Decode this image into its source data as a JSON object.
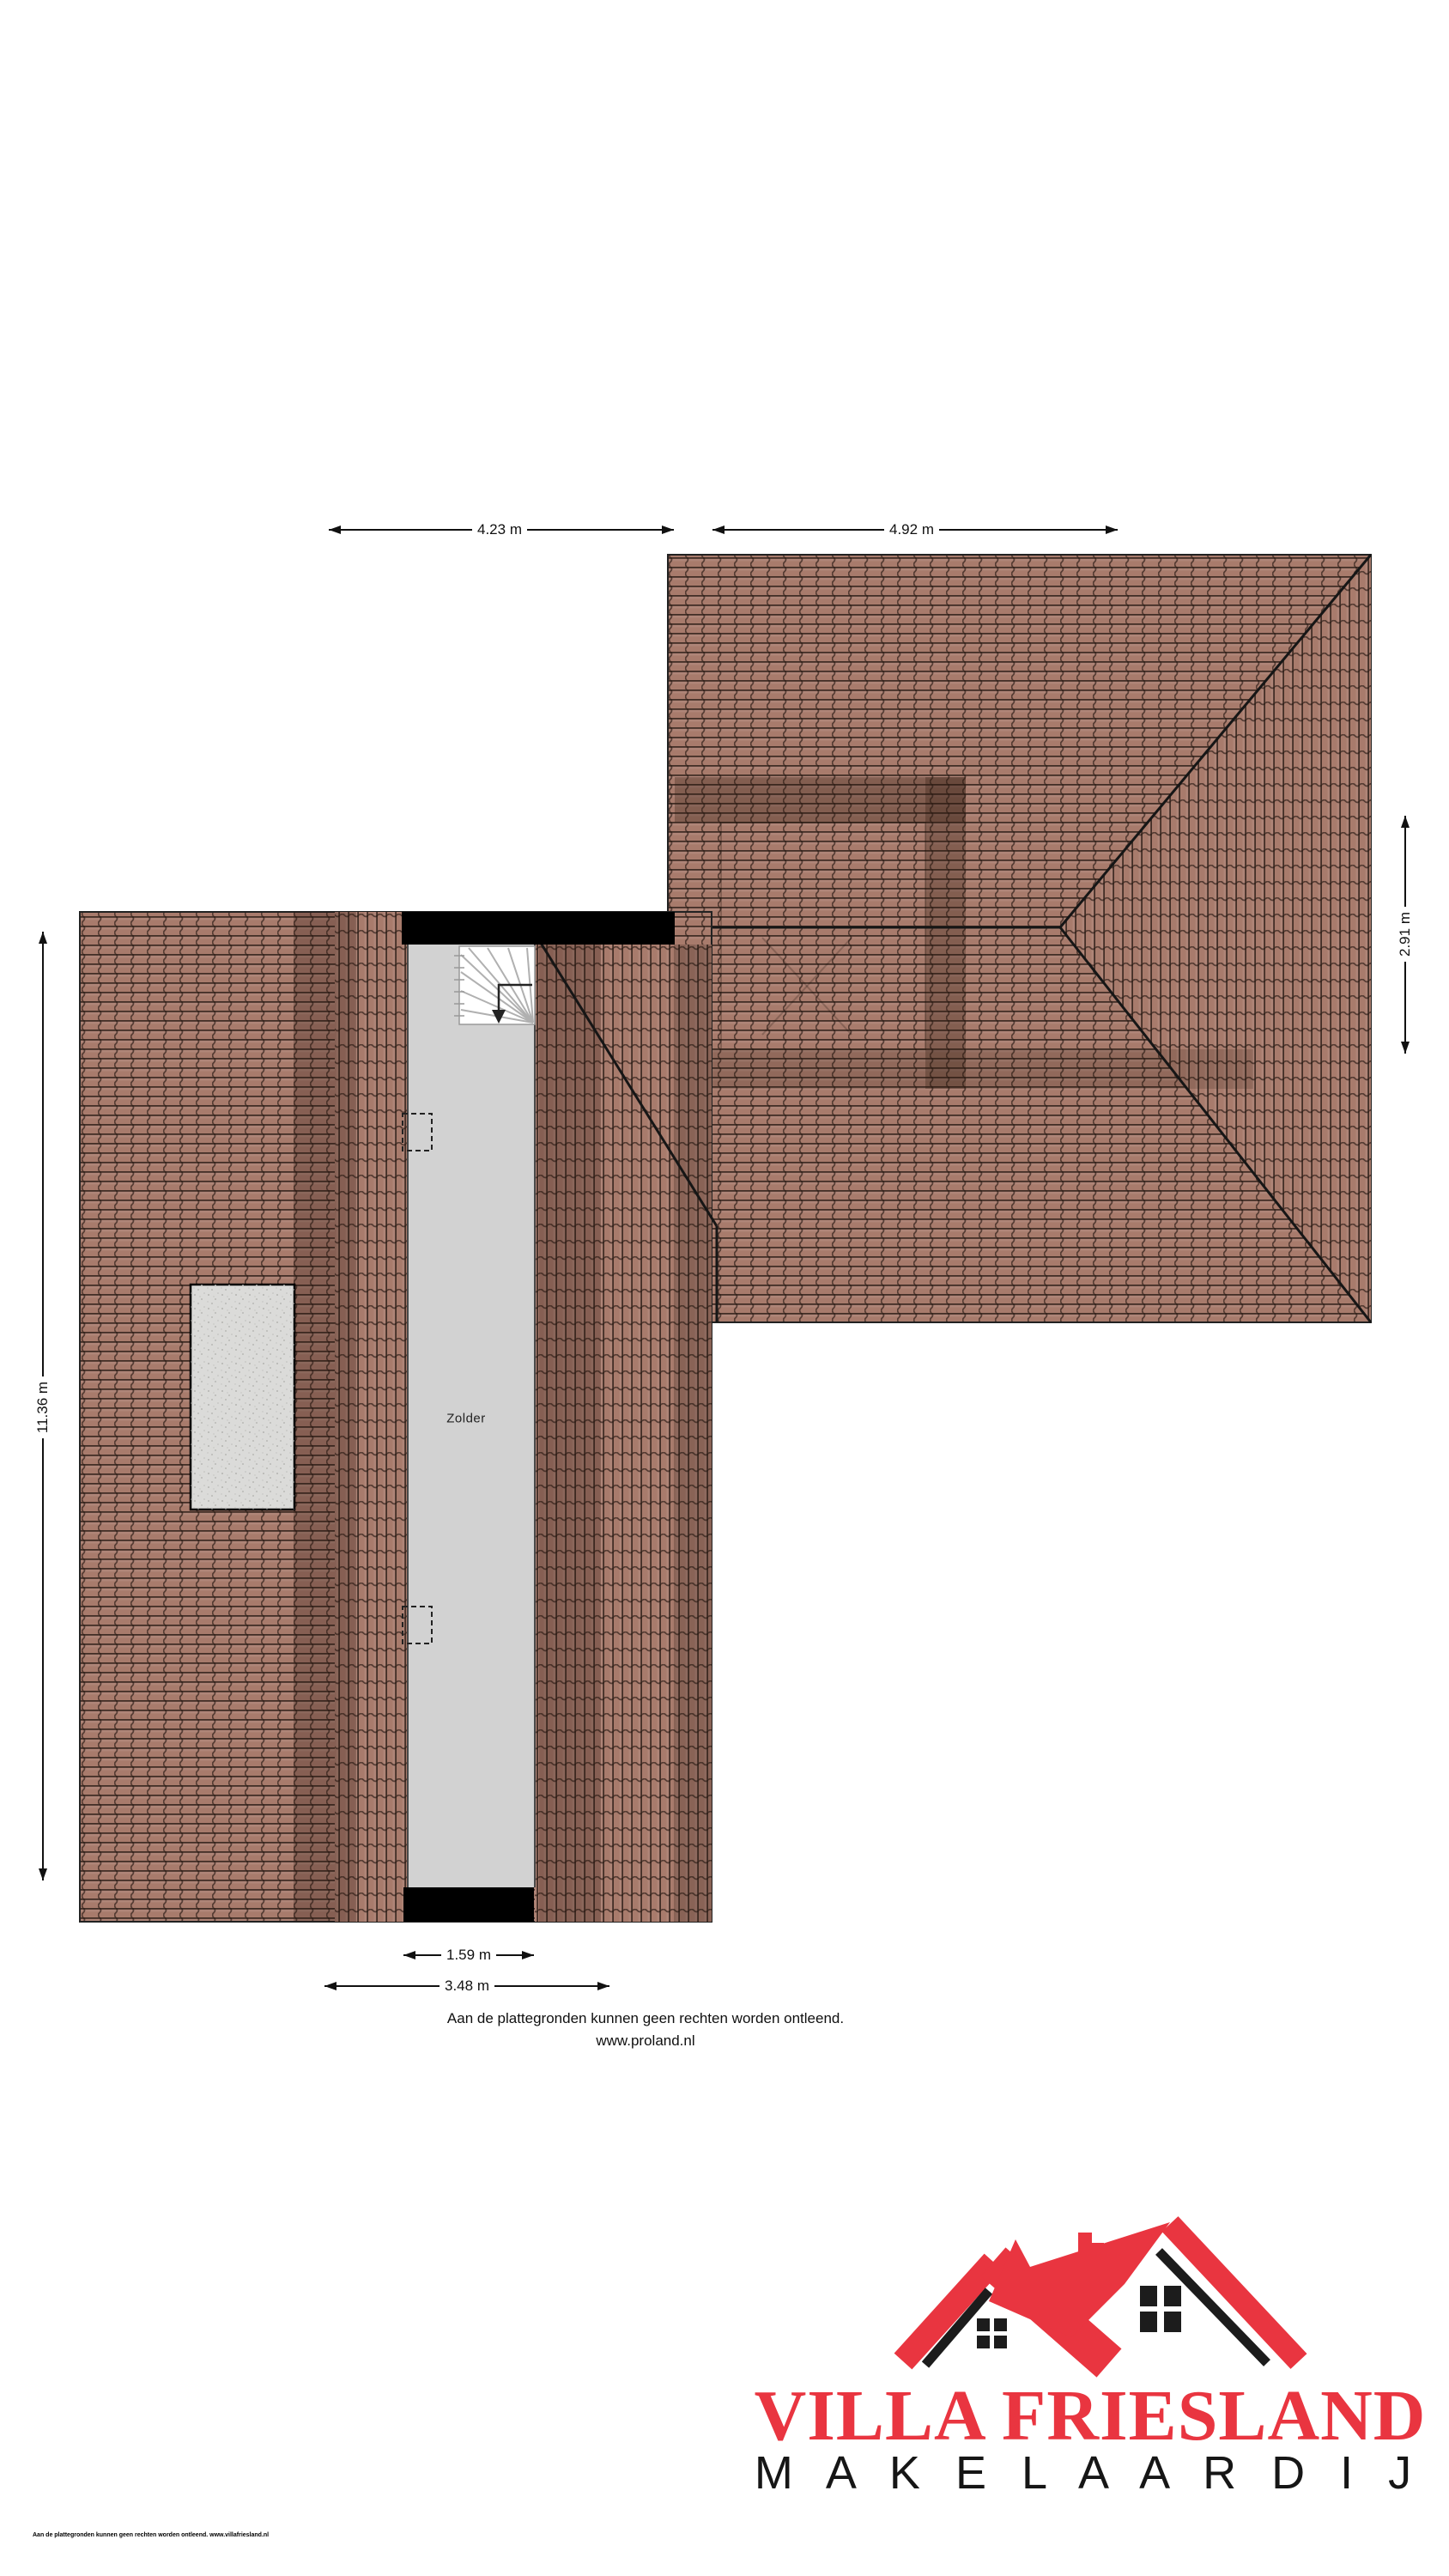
{
  "page": {
    "room_label": "Zolder",
    "dimensions": {
      "top_left": "4.23 m",
      "top_right": "4.92 m",
      "right_side": "2.91 m",
      "left_side": "11.36 m",
      "bottom_inner": "1.59 m",
      "bottom_outer": "3.48 m"
    },
    "disclaimer_line1": "Aan de plattegronden kunnen geen rechten worden ontleend.",
    "disclaimer_line2": "www.proland.nl",
    "footer_small_print": "Aan de plattegronden kunnen geen rechten worden ontleend. www.villafriesland.nl",
    "logo": {
      "name": "VILLA FRIESLAND",
      "tagline": "M A K E L A A R D I J"
    },
    "colors": {
      "tile": "#a87b6c",
      "corridor": "#d2d2d2",
      "wall": "#000000",
      "logo_red": "#e93540",
      "logo_black": "#1c1c1c"
    }
  }
}
